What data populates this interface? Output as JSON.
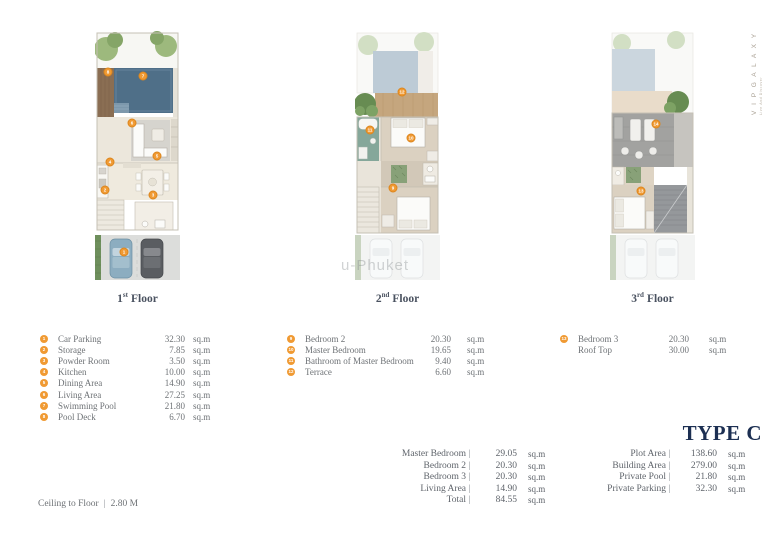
{
  "brand": {
    "name": "V I P   G A L A X Y",
    "tagline": "Live And Discover"
  },
  "watermark": "u-Phuket",
  "type_title": "TYPE C",
  "floors": [
    {
      "label_num": "1",
      "label_sup": "st",
      "label_word": "Floor",
      "legend": [
        {
          "n": "1",
          "name": "Car Parking",
          "value": "32.30",
          "unit": "sq.m"
        },
        {
          "n": "2",
          "name": "Storage",
          "value": "7.85",
          "unit": "sq.m"
        },
        {
          "n": "3",
          "name": "Powder Room",
          "value": "3.50",
          "unit": "sq.m"
        },
        {
          "n": "4",
          "name": "Kitchen",
          "value": "10.00",
          "unit": "sq.m"
        },
        {
          "n": "5",
          "name": "Dining Area",
          "value": "14.90",
          "unit": "sq.m"
        },
        {
          "n": "6",
          "name": "Living Area",
          "value": "27.25",
          "unit": "sq.m"
        },
        {
          "n": "7",
          "name": "Swimming Pool",
          "value": "21.80",
          "unit": "sq.m"
        },
        {
          "n": "8",
          "name": "Pool Deck",
          "value": "6.70",
          "unit": "sq.m"
        }
      ],
      "markers": [
        {
          "n": "8",
          "x": 13,
          "y": 57
        },
        {
          "n": "7",
          "x": 48,
          "y": 61
        },
        {
          "n": "6",
          "x": 37,
          "y": 108
        },
        {
          "n": "4",
          "x": 15,
          "y": 147
        },
        {
          "n": "5",
          "x": 62,
          "y": 141
        },
        {
          "n": "2",
          "x": 10,
          "y": 175
        },
        {
          "n": "3",
          "x": 58,
          "y": 180
        },
        {
          "n": "1",
          "x": 29,
          "y": 237
        }
      ]
    },
    {
      "label_num": "2",
      "label_sup": "nd",
      "label_word": "Floor",
      "legend": [
        {
          "n": "9",
          "name": "Bedroom 2",
          "value": "20.30",
          "unit": "sq.m"
        },
        {
          "n": "10",
          "name": "Master Bedroom",
          "value": "19.65",
          "unit": "sq.m"
        },
        {
          "n": "11",
          "name": "Bathroom of Master Bedroom",
          "value": "9.40",
          "unit": "sq.m"
        },
        {
          "n": "12",
          "name": "Terrace",
          "value": "6.60",
          "unit": "sq.m"
        }
      ],
      "markers": [
        {
          "n": "12",
          "x": 47,
          "y": 77
        },
        {
          "n": "11",
          "x": 15,
          "y": 115
        },
        {
          "n": "10",
          "x": 56,
          "y": 123
        },
        {
          "n": "9",
          "x": 38,
          "y": 173
        }
      ]
    },
    {
      "label_num": "3",
      "label_sup": "rd",
      "label_word": "Floor",
      "legend": [
        {
          "n": "13",
          "name": "Bedroom 3",
          "value": "20.30",
          "unit": "sq.m"
        },
        {
          "n": "",
          "name": "Roof Top",
          "value": "30.00",
          "unit": "sq.m"
        }
      ],
      "markers": [
        {
          "n": "14",
          "x": 46,
          "y": 109
        },
        {
          "n": "13",
          "x": 31,
          "y": 176
        }
      ]
    }
  ],
  "summary_left": [
    {
      "label": "Master Bedroom",
      "value": "29.05",
      "unit": "sq.m"
    },
    {
      "label": "Bedroom 2",
      "value": "20.30",
      "unit": "sq.m"
    },
    {
      "label": "Bedroom 3",
      "value": "20.30",
      "unit": "sq.m"
    },
    {
      "label": "Living Area",
      "value": "14.90",
      "unit": "sq.m"
    },
    {
      "label": "Total",
      "value": "84.55",
      "unit": "sq.m"
    }
  ],
  "summary_right": [
    {
      "label": "Plot Area",
      "value": "138.60",
      "unit": "sq.m"
    },
    {
      "label": "Building Area",
      "value": "279.00",
      "unit": "sq.m"
    },
    {
      "label": "Private Pool",
      "value": "21.80",
      "unit": "sq.m"
    },
    {
      "label": "Private Parking",
      "value": "32.30",
      "unit": "sq.m"
    }
  ],
  "footer": {
    "label": "Ceiling to Floor",
    "separator": "|",
    "value": "2.80 M"
  },
  "colors": {
    "accent_orange": "#F09A33",
    "navy": "#1C2F52",
    "text_gray": "#6E7276",
    "label_dark": "#4A5260",
    "brand_taupe": "#A89F92"
  }
}
